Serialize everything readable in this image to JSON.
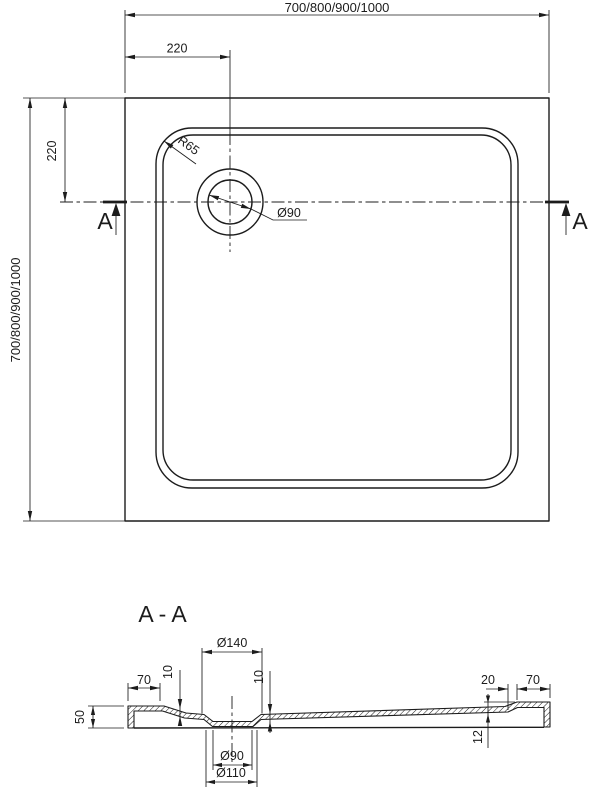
{
  "colors": {
    "line": "#1c1c1c",
    "background": "#ffffff"
  },
  "top_view": {
    "width_dim": "700/800/900/1000",
    "height_dim": "700/800/900/1000",
    "drain_offset_x": "220",
    "drain_offset_y": "220",
    "rim_radius": "R65",
    "drain_diameter": "Ø90",
    "section_label_left": "A",
    "section_label_right": "A"
  },
  "section_view": {
    "title": "A-A",
    "recess_top_diameter": "Ø140",
    "left_flange_width": "70",
    "rim_drop": "10",
    "recess_depth": "10",
    "tray_height": "50",
    "step_width": "20",
    "right_flange_width": "70",
    "edge_thickness": "12",
    "drain_hole_diameter": "Ø90",
    "drain_under_diameter": "Ø110"
  }
}
